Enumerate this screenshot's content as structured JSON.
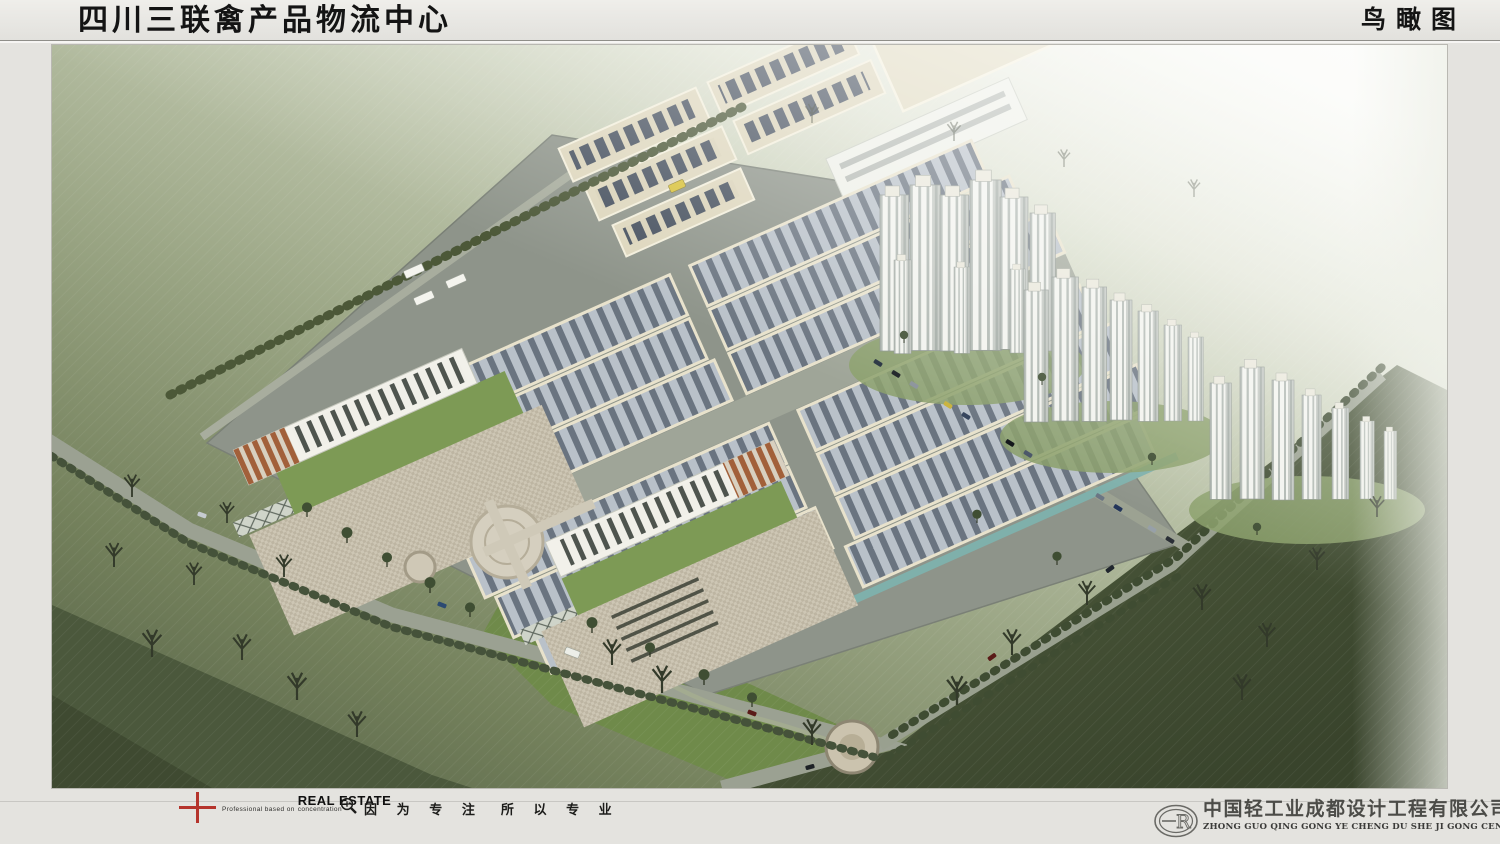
{
  "header": {
    "title": "四川三联禽产品物流中心",
    "view_label": "鸟瞰图"
  },
  "footer": {
    "brand": {
      "pre_text": "Professional based on",
      "brand_name": "REAL ESTATE",
      "post_text": "concentration",
      "slogan_left": "因 为 专 注",
      "slogan_right": "所 以 专 业"
    },
    "company": {
      "logo_text": "R",
      "name": "中国轻工业成都设计工程有限公司",
      "pinyin": "ZHONG GUO QING GONG YE CHENG DU SHE JI GONG CENG YOU XIAN GONG SI"
    }
  },
  "scene": {
    "type": "architectural-birdseye-rendering",
    "palette": {
      "header_bg_top": "#efeeea",
      "header_bg_bottom": "#e2e1dd",
      "page_bg": "#e4e3df",
      "title_ink": "#141414",
      "rule": "#8f8e89",
      "footer_rule": "#c8c7c3",
      "accent_red": "#b5342c",
      "footer_ink": "#1d1d1b",
      "company_ink": "#4c4c48",
      "field_light": "#f6f7f1",
      "field_mid": "#9aa584",
      "field_dark": "#39442c",
      "platform": "#8e948a",
      "warehouse_roof_light": "#b9c1c9",
      "warehouse_roof_dark": "#6a7480",
      "parapet_cream": "#e8e2cc",
      "factory_cream": "#ddd6bc",
      "skylight_blue": "#46505e",
      "office_white": "#f2f1ea",
      "louver_brown": "#a2603a",
      "terrace_green": "#7d9a55",
      "plaza_paving": "#cdc6b4",
      "road": "#9ba192",
      "canal_teal": "#7fb0ab",
      "tower_white": "#f2f3ee",
      "tree_dark": "#333a2a"
    }
  }
}
